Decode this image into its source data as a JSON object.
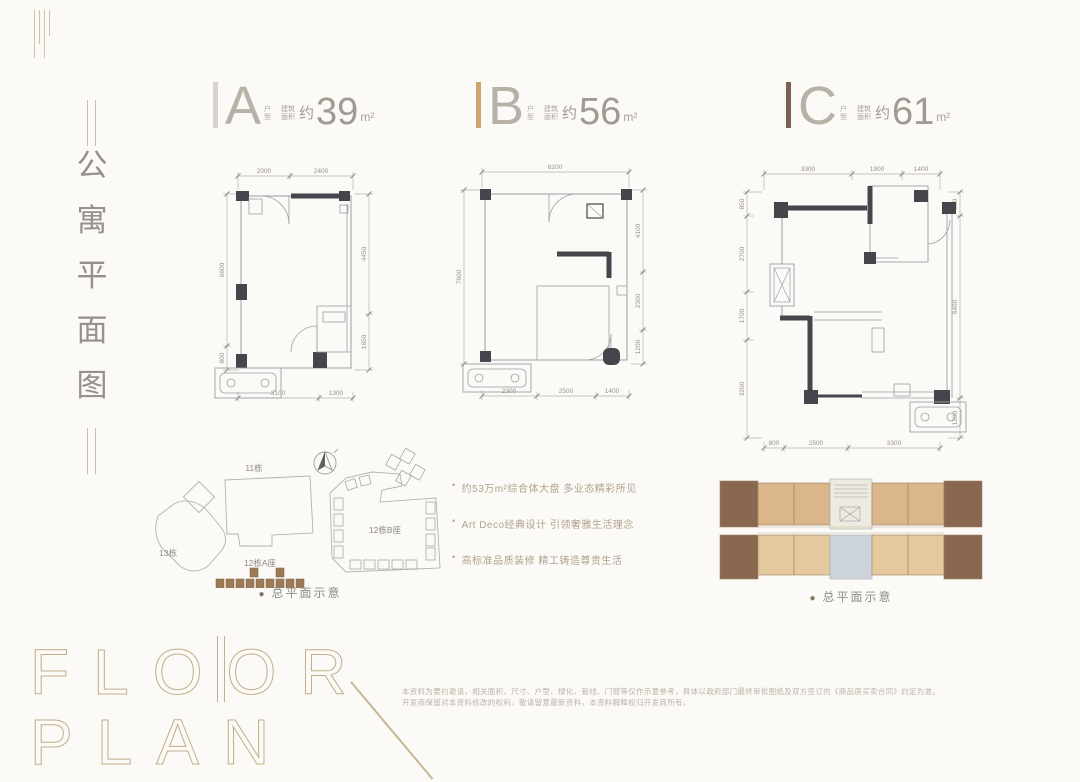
{
  "rail": {
    "chars": [
      "公",
      "寓",
      "平",
      "面",
      "图"
    ]
  },
  "plans": [
    {
      "letter": "A",
      "accent": "#d9d3ca",
      "type_chars": [
        "户",
        "型"
      ],
      "area_label": [
        "建筑",
        "面积"
      ],
      "approx": "约",
      "value": "39",
      "unit": "m²",
      "dims": {
        "top": [
          "2000",
          "2400"
        ],
        "right": [
          "4450",
          "1650"
        ],
        "left": [
          "6600",
          "800"
        ],
        "bottom": [
          "3100",
          "1300"
        ]
      }
    },
    {
      "letter": "B",
      "accent": "#cfa36e",
      "type_chars": [
        "户",
        "型"
      ],
      "area_label": [
        "建筑",
        "面积"
      ],
      "approx": "约",
      "value": "56",
      "unit": "m²",
      "dims": {
        "top": [
          "6200"
        ],
        "right": [
          "4100",
          "2300",
          "1200"
        ],
        "left": [
          "7600"
        ],
        "bottom": [
          "2300",
          "2500",
          "1400"
        ]
      }
    },
    {
      "letter": "C",
      "accent": "#7c6152",
      "type_chars": [
        "户",
        "型"
      ],
      "area_label": [
        "建筑",
        "面积"
      ],
      "approx": "约",
      "value": "61",
      "unit": "m²",
      "dims": {
        "top": [
          "3300",
          "1900",
          "1400"
        ],
        "right": [
          "850",
          "6400",
          "1200"
        ],
        "left": [
          "850",
          "2700",
          "1700",
          "3200"
        ],
        "bottom": [
          "800",
          "2500",
          "3300"
        ]
      }
    }
  ],
  "site_plan": {
    "labels": {
      "b11": "11栋",
      "b12a": "12栋A座",
      "b12b": "12栋B座",
      "b13": "13栋"
    },
    "dot": "●",
    "caption": "总平面示意"
  },
  "key_plan": {
    "dot": "●",
    "caption": "总平面示意"
  },
  "features": {
    "bullet": "•",
    "items": [
      "约53万m²综合体大盘 多业态精彩所见",
      "Art Deco经典设计 引领奢雅生活理念",
      "高标准品质装修 精工铸造尊贵生活"
    ]
  },
  "footer": {
    "word1": "FLOOR",
    "word2": "PLAN",
    "disclaimer_line1": "本资料为要约邀请，相关面积、尺寸、户型、绿化、管线、门窗等仅作示意参考，具体以政府部门最终审批图纸及双方签订的《商品房买卖合同》约定为准。",
    "disclaimer_line2": "开发商保留对本资料修改的权利，敬请留意最新资料，本资料解释权归开发商所有。"
  }
}
